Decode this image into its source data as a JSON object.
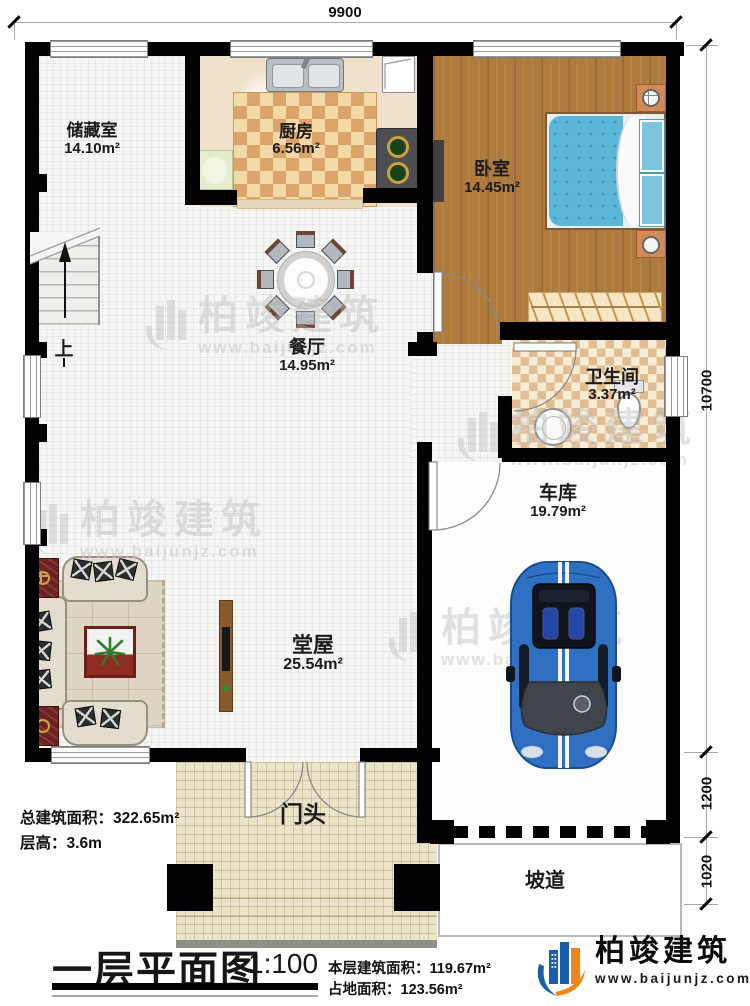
{
  "dimensions": {
    "width_top": "9900",
    "height_right": "10700",
    "garage_front": "1200",
    "ramp_depth": "1020"
  },
  "rooms": {
    "storage": {
      "name": "储藏室",
      "area": "14.10m²"
    },
    "kitchen": {
      "name": "厨房",
      "area": "6.56m²"
    },
    "bedroom": {
      "name": "卧室",
      "area": "14.45m²"
    },
    "dining": {
      "name": "餐厅",
      "area": "14.95m²"
    },
    "bathroom": {
      "name": "卫生间",
      "area": "3.37m²"
    },
    "garage": {
      "name": "车库",
      "area": "19.79m²"
    },
    "hall": {
      "name": "堂屋",
      "area": "25.54m²"
    },
    "porch": {
      "name": "门头"
    },
    "ramp": {
      "name": "坡道"
    }
  },
  "stairs": {
    "up_label": "上"
  },
  "summary": {
    "total_area_label": "总建筑面积：",
    "total_area": "322.65m²",
    "floor_height_label": "层高：",
    "floor_height": "3.6m",
    "floor_area_label": "本层建筑面积：",
    "floor_area": "119.67m²",
    "footprint_label": "占地面积：",
    "footprint": "123.56m²"
  },
  "title_block": {
    "title": "一层平面图",
    "scale": "1:100"
  },
  "brand": {
    "name": "柏竣建筑",
    "website": "www.baijunjz.com"
  },
  "watermark": {
    "name": "柏竣建筑",
    "website": "www.baijunjz.com"
  },
  "colors": {
    "wall": "#000000",
    "brand_blue": "#1a5dab",
    "brand_orange": "#f08519",
    "bed_blue": "#5cb6d8",
    "car_blue": "#2f70c2",
    "wood": "#b07c3e",
    "kitchen_checker": "#dca468",
    "bath_checker": "#e3bd92"
  }
}
